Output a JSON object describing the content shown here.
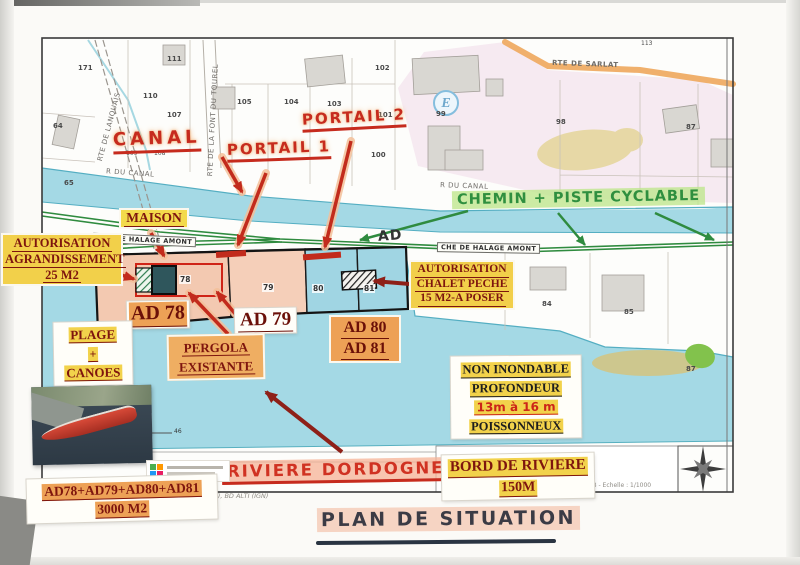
{
  "map": {
    "roads": {
      "sarlat": "RTE DE SARLAT",
      "lanquais": "RTE DE LANQUAIS",
      "font_du_tourel": "RTE DE LA FONT DU TOUREL",
      "r_du_canal_left": "R DU CANAL",
      "r_du_canal_right": "R DU CANAL",
      "halage_left": "CHE DE HALAGE AMONT",
      "halage_right": "CHE DE HALAGE AMONT"
    },
    "e_marker": "E",
    "parcels": [
      "171",
      "111",
      "110",
      "107",
      "64",
      "65",
      "109",
      "108",
      "105",
      "104",
      "103",
      "102",
      "101",
      "100",
      "99",
      "113",
      "98",
      "87",
      "78",
      "79",
      "80",
      "81",
      "84",
      "85",
      "87",
      "46"
    ]
  },
  "annotations": {
    "canal": "CANAL",
    "portail_1": "PORTAIL 1",
    "portail_2": "PORTAIL 2",
    "maison": "MAISON",
    "agrandissement": {
      "l1": "AUTORISATION",
      "l2": "AGRANDISSEMENT",
      "l3": "25 M2"
    },
    "chemin_piste": "CHEMIN + PISTE CYCLABLE",
    "ad_path": "AD",
    "chalet": {
      "l1": "AUTORISATION",
      "l2": "CHALET PECHE",
      "l3": "15 M2-A POSER"
    },
    "ad78": "AD 78",
    "ad79": "AD 79",
    "ad80": "AD 80",
    "ad81": "AD 81",
    "plage": {
      "l1": "PLAGE",
      "l2": "+",
      "l3": "CANOES"
    },
    "pergola": {
      "l1": "PERGOLA",
      "l2": "EXISTANTE"
    },
    "non_inondable": {
      "l1": "NON INONDABLE",
      "l2": "PROFONDEUR",
      "l3": "13m à 16 m",
      "l4": "POISSONNEUX"
    },
    "riviere": "RIVIERE DORDOGNE",
    "bord": {
      "l1": "BORD DE RIVIERE",
      "l2": "150M"
    },
    "total": {
      "l1": "AD78+AD79+AD80+AD81",
      "l2": "3000 M2"
    }
  },
  "footer": {
    "attribution": "DS - sources : BD TOPO (IGN, 2013), BD ALTI (IGN)",
    "scale": "29/06/2018 - Echelle : 1/1000",
    "title": "PLAN DE SITUATION"
  },
  "colors": {
    "water": "#a4d9e5",
    "parcel_salmon": "#f3c9b1",
    "parcel_cyan": "#a0d5e3",
    "highlight_yellow": "#f2d24b",
    "highlight_orange": "#eda156",
    "red_ink": "#c62b1e",
    "dark_red": "#7e150e",
    "green_ink": "#2f8f3f",
    "road_orange": "#efa95f",
    "highlight_pink": "#f4baa0",
    "highlight_green": "#bee68c"
  }
}
